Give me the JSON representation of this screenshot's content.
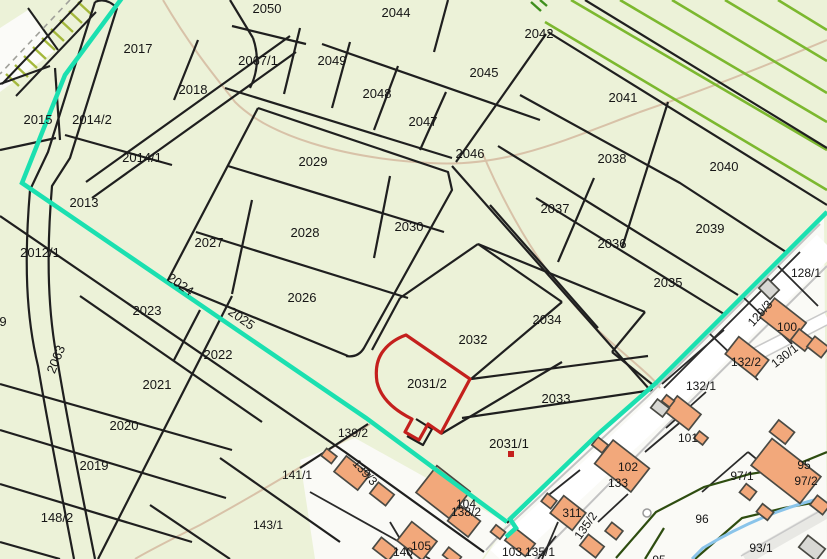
{
  "map": {
    "type": "cadastral-parcel-map",
    "colors": {
      "parcel_fill": "#ecf2d8",
      "village_fill": "#fafaf6",
      "boundary_black": "#1f1f1f",
      "selection_boundary_cyan": "#1be0b0",
      "highlight_red": "#c4201d",
      "building_orange": "#f2a87b",
      "building_gray": "#d8d8d4",
      "hatch_green": "#7cb82f",
      "stream_blue": "#8ac4ea",
      "bank_dark_green": "#2e4d10",
      "path_tan": "#d8c2a8",
      "road_casing_gray": "#c3c3c3"
    },
    "highlight": {
      "selected_parcel": "2031/2",
      "marked_parcel": "2031/1"
    },
    "parcel_labels": [
      {
        "text": "2050",
        "x": 267,
        "y": 13
      },
      {
        "text": "2044",
        "x": 396,
        "y": 17
      },
      {
        "text": "2042",
        "x": 539,
        "y": 38
      },
      {
        "text": "2017",
        "x": 138,
        "y": 53
      },
      {
        "text": "2067/1",
        "x": 258,
        "y": 65
      },
      {
        "text": "2049",
        "x": 332,
        "y": 65
      },
      {
        "text": "2045",
        "x": 484,
        "y": 77
      },
      {
        "text": "2018",
        "x": 193,
        "y": 94
      },
      {
        "text": "2048",
        "x": 377,
        "y": 98
      },
      {
        "text": "2041",
        "x": 623,
        "y": 102
      },
      {
        "text": "2015",
        "x": 38,
        "y": 124
      },
      {
        "text": "2014/2",
        "x": 92,
        "y": 124
      },
      {
        "text": "2047",
        "x": 423,
        "y": 126
      },
      {
        "text": "2014/1",
        "x": 142,
        "y": 162
      },
      {
        "text": "2046",
        "x": 470,
        "y": 158
      },
      {
        "text": "2029",
        "x": 313,
        "y": 166
      },
      {
        "text": "2038",
        "x": 612,
        "y": 163
      },
      {
        "text": "2040",
        "x": 724,
        "y": 171
      },
      {
        "text": "2013",
        "x": 84,
        "y": 207
      },
      {
        "text": "2037",
        "x": 555,
        "y": 213
      },
      {
        "text": "2030",
        "x": 409,
        "y": 231
      },
      {
        "text": "2039",
        "x": 710,
        "y": 233
      },
      {
        "text": "2028",
        "x": 305,
        "y": 237
      },
      {
        "text": "2027",
        "x": 209,
        "y": 247
      },
      {
        "text": "2036",
        "x": 612,
        "y": 248
      },
      {
        "text": "2012/1",
        "x": 40,
        "y": 257
      },
      {
        "text": "128/1",
        "x": 806,
        "y": 277,
        "cls": "lbl-sm"
      },
      {
        "text": "2035",
        "x": 668,
        "y": 287
      },
      {
        "text": "2026",
        "x": 302,
        "y": 302
      },
      {
        "text": "2024",
        "x": 178,
        "y": 288,
        "rot": 35
      },
      {
        "text": "2025",
        "x": 239,
        "y": 322,
        "rot": 35
      },
      {
        "text": "129/3",
        "x": 763,
        "y": 316,
        "rot": -48,
        "cls": "lbl-sm"
      },
      {
        "text": "2023",
        "x": 147,
        "y": 315
      },
      {
        "text": "2034",
        "x": 547,
        "y": 324
      },
      {
        "text": "100",
        "x": 787,
        "y": 331,
        "cls": "lbl-sm"
      },
      {
        "text": "9",
        "x": 3,
        "y": 326
      },
      {
        "text": "2032",
        "x": 473,
        "y": 344
      },
      {
        "text": "2022",
        "x": 218,
        "y": 359
      },
      {
        "text": "130/1",
        "x": 787,
        "y": 359,
        "rot": -38,
        "cls": "lbl-sm"
      },
      {
        "text": "132/2",
        "x": 746,
        "y": 366,
        "cls": "lbl-sm"
      },
      {
        "text": "2063",
        "x": 60,
        "y": 361,
        "rot": -68
      },
      {
        "text": "2021",
        "x": 157,
        "y": 389
      },
      {
        "text": "2031/2",
        "x": 427,
        "y": 388
      },
      {
        "text": "132/1",
        "x": 701,
        "y": 390,
        "cls": "lbl-sm"
      },
      {
        "text": "2033",
        "x": 556,
        "y": 403
      },
      {
        "text": "2020",
        "x": 124,
        "y": 430
      },
      {
        "text": "139/2",
        "x": 353,
        "y": 437,
        "cls": "lbl-sm"
      },
      {
        "text": "101",
        "x": 688,
        "y": 442,
        "cls": "lbl-sm"
      },
      {
        "text": "2031/1",
        "x": 509,
        "y": 448
      },
      {
        "text": "95",
        "x": 804,
        "y": 469,
        "cls": "lbl-sm"
      },
      {
        "text": "2019",
        "x": 94,
        "y": 470
      },
      {
        "text": "141/1",
        "x": 297,
        "y": 479,
        "cls": "lbl-sm"
      },
      {
        "text": "97/1",
        "x": 742,
        "y": 480,
        "cls": "lbl-sm"
      },
      {
        "text": "102",
        "x": 628,
        "y": 471,
        "cls": "lbl-sm"
      },
      {
        "text": "97/2",
        "x": 806,
        "y": 485,
        "cls": "lbl-sm"
      },
      {
        "text": "133",
        "x": 618,
        "y": 487,
        "cls": "lbl-sm"
      },
      {
        "text": "139/3",
        "x": 362,
        "y": 475,
        "rot": 48,
        "cls": "lbl-sm"
      },
      {
        "text": "104",
        "x": 466,
        "y": 508,
        "cls": "lbl-sm"
      },
      {
        "text": "138/2",
        "x": 466,
        "y": 516,
        "cls": "lbl-sm"
      },
      {
        "text": "148/2",
        "x": 57,
        "y": 522
      },
      {
        "text": "311",
        "x": 572,
        "y": 517,
        "cls": "lbl-sm"
      },
      {
        "text": "96",
        "x": 702,
        "y": 523,
        "cls": "lbl-sm"
      },
      {
        "text": "135/2",
        "x": 589,
        "y": 528,
        "rot": -55,
        "cls": "lbl-sm"
      },
      {
        "text": "143/1",
        "x": 268,
        "y": 529,
        "cls": "lbl-sm"
      },
      {
        "text": "105",
        "x": 421,
        "y": 550,
        "cls": "lbl-sm"
      },
      {
        "text": "140",
        "x": 403,
        "y": 556,
        "cls": "lbl-sm"
      },
      {
        "text": "103",
        "x": 512,
        "y": 556,
        "cls": "lbl-sm"
      },
      {
        "text": "135/1",
        "x": 540,
        "y": 556,
        "cls": "lbl-sm"
      },
      {
        "text": "93/1",
        "x": 761,
        "y": 552,
        "cls": "lbl-sm"
      },
      {
        "text": "95",
        "x": 659,
        "y": 564,
        "cls": "lbl-sm"
      }
    ],
    "buildings": [
      {
        "cx": 352,
        "cy": 473,
        "w": 30,
        "h": 20,
        "rot": 38
      },
      {
        "cx": 329,
        "cy": 456,
        "w": 13,
        "h": 9,
        "rot": 38
      },
      {
        "cx": 382,
        "cy": 494,
        "w": 20,
        "h": 14,
        "rot": 38
      },
      {
        "cx": 443,
        "cy": 492,
        "w": 42,
        "h": 34,
        "rot": 38
      },
      {
        "cx": 464,
        "cy": 521,
        "w": 26,
        "h": 20,
        "rot": 38
      },
      {
        "cx": 417,
        "cy": 541,
        "w": 32,
        "h": 24,
        "rot": 38
      },
      {
        "cx": 385,
        "cy": 549,
        "w": 20,
        "h": 14,
        "rot": 38
      },
      {
        "cx": 452,
        "cy": 556,
        "w": 16,
        "h": 10,
        "rot": 38
      },
      {
        "cx": 520,
        "cy": 542,
        "w": 26,
        "h": 16,
        "rot": 38
      },
      {
        "cx": 568,
        "cy": 513,
        "w": 28,
        "h": 22,
        "rot": 38
      },
      {
        "cx": 549,
        "cy": 501,
        "w": 12,
        "h": 10,
        "rot": 38
      },
      {
        "cx": 592,
        "cy": 546,
        "w": 20,
        "h": 14,
        "rot": 38
      },
      {
        "cx": 614,
        "cy": 531,
        "w": 14,
        "h": 11,
        "rot": 38
      },
      {
        "cx": 622,
        "cy": 466,
        "w": 46,
        "h": 30,
        "rot": 38
      },
      {
        "cx": 600,
        "cy": 445,
        "w": 13,
        "h": 10,
        "rot": 38
      },
      {
        "cx": 683,
        "cy": 413,
        "w": 30,
        "h": 20,
        "rot": 38
      },
      {
        "cx": 668,
        "cy": 401,
        "w": 10,
        "h": 8,
        "rot": 38
      },
      {
        "cx": 701,
        "cy": 438,
        "w": 11,
        "h": 9,
        "rot": 38
      },
      {
        "cx": 747,
        "cy": 357,
        "w": 38,
        "h": 22,
        "rot": 38
      },
      {
        "cx": 783,
        "cy": 320,
        "w": 40,
        "h": 24,
        "rot": 38
      },
      {
        "cx": 802,
        "cy": 340,
        "w": 18,
        "h": 14,
        "rot": 38
      },
      {
        "cx": 782,
        "cy": 432,
        "w": 20,
        "h": 15,
        "rot": 38
      },
      {
        "cx": 786,
        "cy": 471,
        "w": 62,
        "h": 34,
        "rot": 38
      },
      {
        "cx": 748,
        "cy": 492,
        "w": 13,
        "h": 11,
        "rot": 38
      },
      {
        "cx": 820,
        "cy": 505,
        "w": 16,
        "h": 12,
        "rot": 38
      },
      {
        "cx": 818,
        "cy": 347,
        "w": 18,
        "h": 13,
        "rot": 38
      },
      {
        "cx": 498,
        "cy": 532,
        "w": 12,
        "h": 9,
        "rot": 38
      },
      {
        "cx": 765,
        "cy": 512,
        "w": 14,
        "h": 10,
        "rot": 38
      },
      {
        "cx": 769,
        "cy": 289,
        "w": 16,
        "h": 13,
        "rot": 45,
        "gray": true
      },
      {
        "cx": 660,
        "cy": 408,
        "w": 15,
        "h": 11,
        "rot": 38,
        "gray": true
      },
      {
        "cx": 812,
        "cy": 548,
        "w": 22,
        "h": 15,
        "rot": 38,
        "gray": true
      }
    ]
  }
}
